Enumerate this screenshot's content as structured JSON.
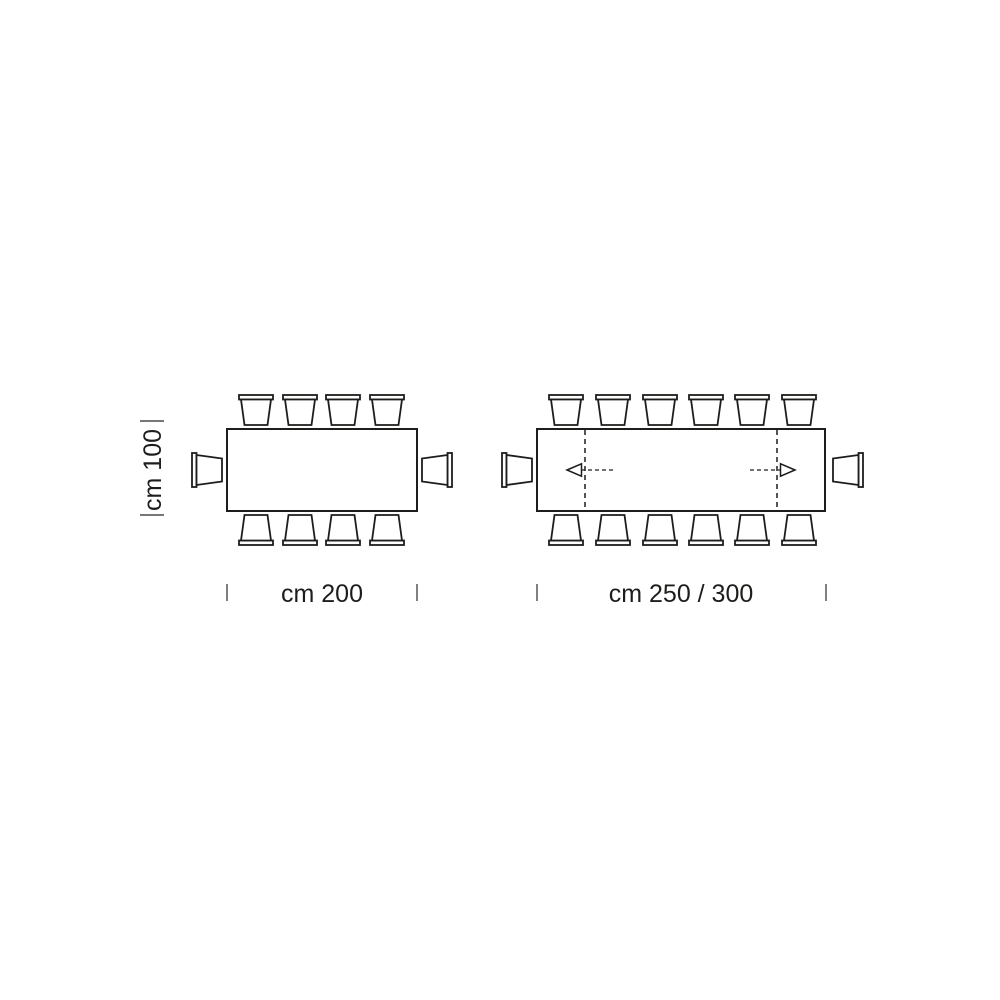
{
  "page": {
    "background_color": "#ffffff"
  },
  "diagram": {
    "kind": "table-seating-dimension-diagram",
    "line_color": "#1d1d1b",
    "tick_color": "#4a4a4a",
    "labels": {
      "depth": "cm 100",
      "table1_width": "cm 200",
      "table2_width": "cm 250 / 300"
    },
    "tables": [
      {
        "name": "fixed-table",
        "shape": "rectangle",
        "width_label": "cm 200",
        "depth_label": "cm 100",
        "chairs": {
          "top": 4,
          "bottom": 4,
          "left": 1,
          "right": 1,
          "total": 10
        },
        "extendable": false
      },
      {
        "name": "extendable-table",
        "shape": "rectangle",
        "width_label": "cm 250 / 300",
        "depth_label": "cm 100",
        "chairs": {
          "top": 6,
          "bottom": 6,
          "left": 1,
          "right": 1,
          "total": 14
        },
        "extendable": true,
        "extension_indicator": "dashed-leaf-lines-with-outward-arrows"
      }
    ]
  }
}
